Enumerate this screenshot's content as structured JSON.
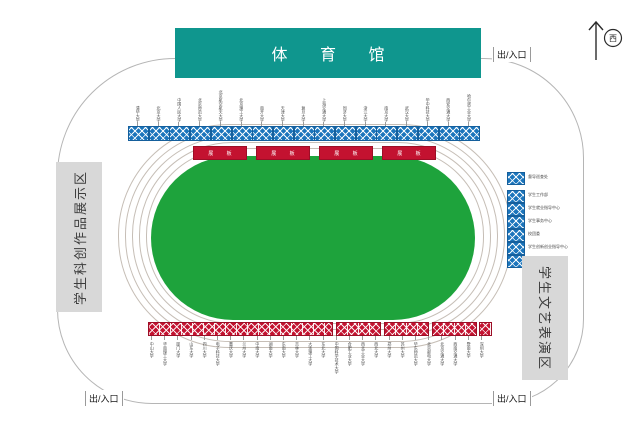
{
  "building": {
    "label": "体 育 馆"
  },
  "compass": {
    "direction": "西"
  },
  "entrance_label": "出/入口",
  "zones": {
    "left": "学生科创作品展示区",
    "right": "学生文艺表演区"
  },
  "boards": {
    "label": "展 板",
    "count": 4
  },
  "top_booths": [
    "清华大学",
    "北京大学",
    "中国人民大学",
    "北京师范大学",
    "北京航空航天大学",
    "北京理工大学",
    "南开大学",
    "天津大学",
    "复旦大学",
    "上海交通大学",
    "同济大学",
    "浙江大学",
    "南京大学",
    "武汉大学",
    "华中科技大学",
    "西安交通大学",
    "哈尔滨工业大学"
  ],
  "right_offices": [
    "督导巡查处",
    "学生工作部",
    "学生就业指导中心",
    "学生事务中心",
    "校团委",
    "学生创新创业指导中心",
    "大学生中心"
  ],
  "bottom_booths": [
    "中山大学",
    "华南理工大学",
    "厦门大学",
    "山东大学",
    "四川大学",
    "电子科技大学",
    "重庆大学",
    "兰州大学",
    "中南大学",
    "湖南大学",
    "东南大学",
    "吉林大学",
    "大连理工大学",
    "东北大学",
    "中国科学技术大学",
    "合肥工业大学",
    "西北工业大学",
    "西北大学",
    "郑州大学",
    "苏州大学",
    "华东师范大学",
    "北京邮电大学",
    "北京交通大学",
    "西南交通大学",
    "暨南大学",
    "深圳大学"
  ],
  "colors": {
    "teal": "#0f968e",
    "field_green": "#1ea33c",
    "booth_blue": "#1b75bc",
    "booth_red": "#c31230",
    "zone_gray": "#d8d8d8"
  }
}
